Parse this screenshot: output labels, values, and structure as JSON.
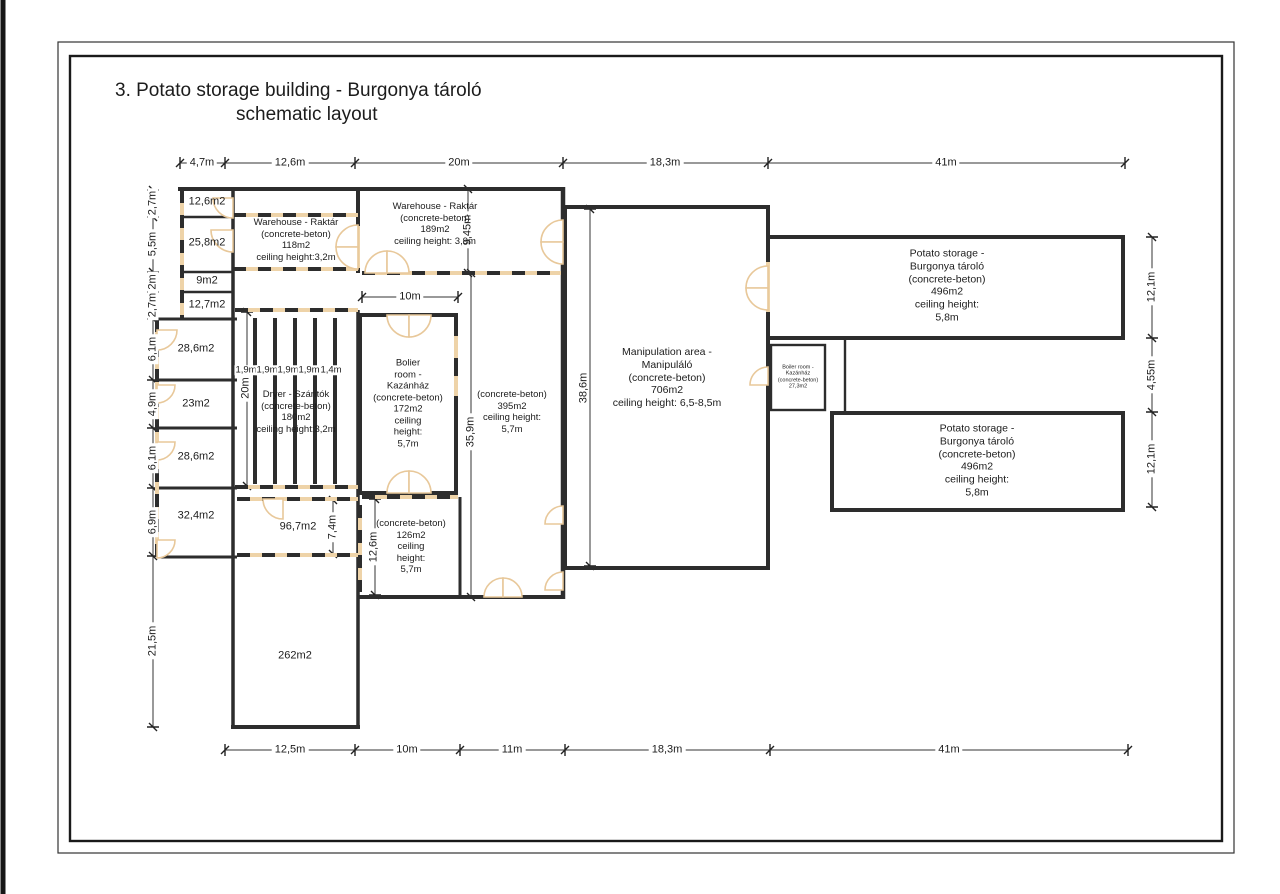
{
  "title": {
    "line1": "3. Potato storage building - Burgonya tároló",
    "line2": "schematic layout"
  },
  "colors": {
    "wall": "#2d2d2d",
    "door": "#e8c89a",
    "dim_line": "#333333"
  },
  "dims": {
    "top": [
      "4,7m",
      "12,6m",
      "20m",
      "18,3m",
      "41m"
    ],
    "bottom": [
      "12,5m",
      "10m",
      "11m",
      "18,3m",
      "41m"
    ],
    "left": [
      "2,7m",
      "5,5m",
      "2m",
      "2,7m",
      "6,1m",
      "4,9m",
      "6,1m",
      "6,9m",
      "21,5m"
    ],
    "right": [
      "12,1m",
      "4,55m",
      "12,1m"
    ],
    "inner": {
      "warehouse189_height": "9,45m",
      "boiler_width": "10m",
      "hall_height": "35,9m",
      "manipulation_height": "38,6m",
      "dryer_height": "20m",
      "room967_height": "7,4m",
      "room126_height": "12,6m"
    },
    "dryer_bays": [
      "1,9m",
      "1,9m",
      "1,9m",
      "1,9m",
      "1,4m"
    ]
  },
  "rooms": {
    "r126a": "12,6m2",
    "r258": "25,8m2",
    "r9": "9m2",
    "r127": "12,7m2",
    "r286a": "28,6m2",
    "r23": "23m2",
    "r286b": "28,6m2",
    "r324": "32,4m2",
    "r967": "96,7m2",
    "r262": "262m2",
    "warehouse118": "Warehouse - Raktár\n(concrete-beton)\n118m2\nceiling height:3,2m",
    "warehouse189": "Warehouse - Raktár\n(concrete-beton)\n189m2\nceiling height: 3,9m",
    "dryer": "Dryer - Szárítók\n(concrete-beton)\n180m2\nceiling height:3,2m",
    "boiler": "Bolier\nroom -\nKazánház\n(concrete-beton)\n172m2\nceiling\nheight:\n5,7m",
    "hall395": "(concrete-beton)\n395m2\nceiling height:\n5,7m",
    "room126": "(concrete-beton)\n126m2\nceiling\nheight:\n5,7m",
    "manipulation": "Manipulation area -\nManipuláló\n(concrete-beton)\n706m2\nceiling height: 6,5-8,5m",
    "storage_top": "Potato storage -\nBurgonya tároló\n(concrete-beton)\n496m2\nceiling height:\n5,8m",
    "storage_bottom": "Potato storage -\nBurgonya tároló\n(concrete-beton)\n496m2\nceiling height:\n5,8m",
    "boiler_small": "Boiler room -\nKazánház\n(concrete-beton)\n27,3m2"
  }
}
